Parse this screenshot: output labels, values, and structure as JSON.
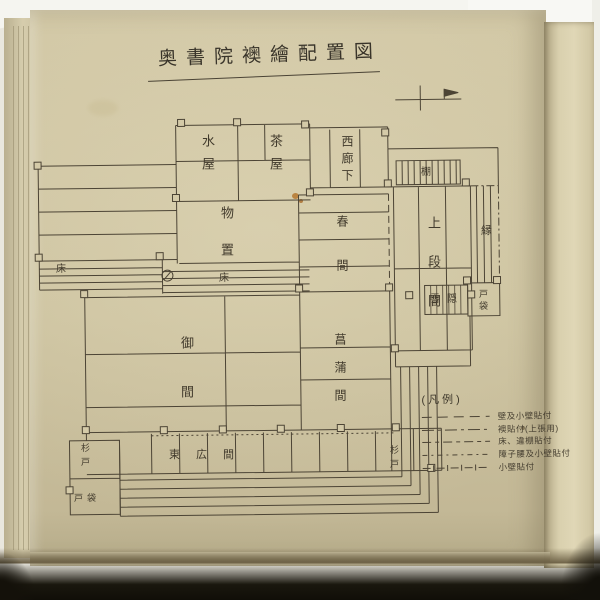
{
  "page": {
    "title": "奥書院襖繪配置図"
  },
  "icons": {
    "scale_mark": "scale-bar-with-flag",
    "circle_mark": "circled-slash"
  },
  "plan": {
    "rooms": [
      {
        "id": "mizuya",
        "label": "水屋"
      },
      {
        "id": "chaya",
        "label": "茶屋"
      },
      {
        "id": "nishi-roka",
        "label": "西廊下"
      },
      {
        "id": "tana",
        "label": "棚"
      },
      {
        "id": "jodan-no-ma",
        "label": "上段間"
      },
      {
        "id": "en",
        "label": "縁"
      },
      {
        "id": "monooki",
        "label": "物置"
      },
      {
        "id": "haru-no-ma",
        "label": "春間"
      },
      {
        "id": "toko-left",
        "label": "床"
      },
      {
        "id": "toko-mid",
        "label": "床"
      },
      {
        "id": "setchin",
        "label": "雪隠"
      },
      {
        "id": "tobukuro-right",
        "label": "戸袋"
      },
      {
        "id": "on-ma",
        "label": "御間"
      },
      {
        "id": "shobu-no-ma",
        "label": "菖蒲間"
      },
      {
        "id": "higashi-hiroma",
        "label": "東広間"
      },
      {
        "id": "sugido-left",
        "label": "杉戸"
      },
      {
        "id": "tobukuro-left",
        "label": "戸袋"
      },
      {
        "id": "sugido-right",
        "label": "杉戸"
      }
    ]
  },
  "legend": {
    "header": "(凡例)",
    "entries": [
      {
        "pattern": "long-dash",
        "label": "壁及小壁貼付"
      },
      {
        "pattern": "dash-dot",
        "label": "襖貼付(上張用)"
      },
      {
        "pattern": "dash-short",
        "label": "床、違棚貼付"
      },
      {
        "pattern": "short-dash-dot",
        "label": "障子腰及小壁貼付"
      },
      {
        "pattern": "dash-cross",
        "label": "小壁貼付"
      }
    ]
  },
  "colors": {
    "paper": "#ccc29f",
    "ink": "#4c4435",
    "backdrop": "#f5f5f0",
    "shadow": "#16130c"
  }
}
